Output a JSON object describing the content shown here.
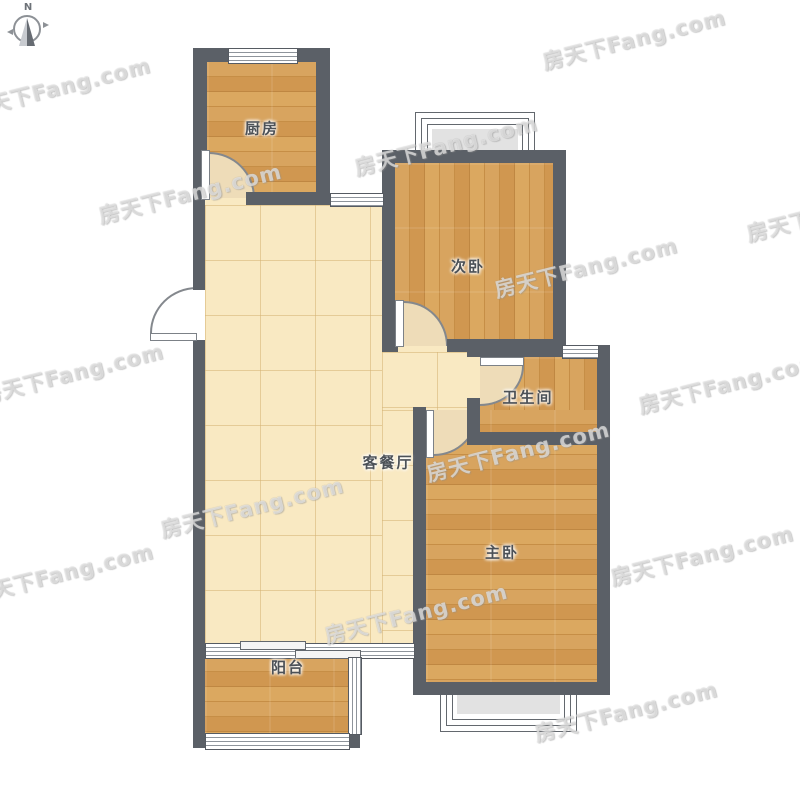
{
  "compass": {
    "north_label": "N"
  },
  "watermark": {
    "text": "房天下Fang.com",
    "rotation_deg": -14,
    "positions": [
      [
        -35,
        72
      ],
      [
        96,
        178
      ],
      [
        540,
        24
      ],
      [
        352,
        130
      ],
      [
        -22,
        358
      ],
      [
        158,
        492
      ],
      [
        424,
        436
      ],
      [
        492,
        252
      ],
      [
        744,
        196
      ],
      [
        322,
        598
      ],
      [
        -32,
        558
      ],
      [
        532,
        696
      ],
      [
        608,
        540
      ],
      [
        636,
        368
      ]
    ]
  },
  "rooms": [
    {
      "id": "kitchen",
      "label": "厨房",
      "floor": "wood"
    },
    {
      "id": "second-bedroom",
      "label": "次卧",
      "floor": "wood"
    },
    {
      "id": "bathroom",
      "label": "卫生间",
      "floor": "wood"
    },
    {
      "id": "living-dining",
      "label": "客餐厅",
      "floor": "tile"
    },
    {
      "id": "master-bedroom",
      "label": "主卧",
      "floor": "wood"
    },
    {
      "id": "balcony",
      "label": "阳台",
      "floor": "wood"
    }
  ],
  "colors": {
    "wall": "#5b6067",
    "wood_floor": "#d19b52",
    "tile_floor": "#f9e9c2",
    "bay_window_fill": "#e2e2e2",
    "label_text": "#4c5157"
  }
}
